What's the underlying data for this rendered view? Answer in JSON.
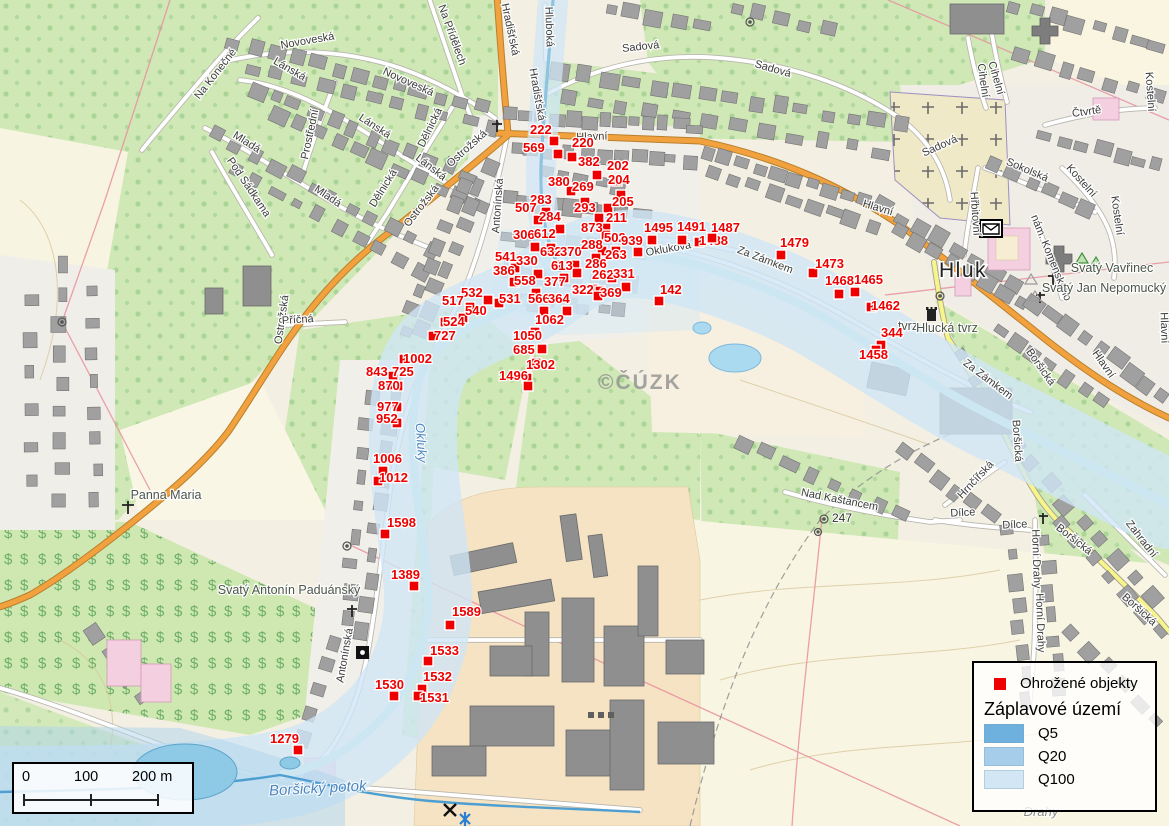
{
  "legend": {
    "objects_label": "Ohrožené objekty",
    "flood_title": "Záplavové území",
    "marker_color": "#ee0000",
    "flood_zones": [
      {
        "label": "Q5",
        "color": "#6fb1de"
      },
      {
        "label": "Q20",
        "color": "#a6cde9"
      },
      {
        "label": "Q100",
        "color": "#d2e6f4"
      }
    ]
  },
  "scalebar": {
    "labels": [
      "0",
      "100",
      "200 m"
    ]
  },
  "watermark": "©ČÚZK",
  "rivers": [
    {
      "name": "Okluky",
      "x": 417,
      "y": 443,
      "r": 86,
      "cls": "riv"
    },
    {
      "name": "Boršický potok",
      "x": 318,
      "y": 793,
      "r": -3,
      "cls": "rivbig"
    }
  ],
  "poi_labels": [
    {
      "t": "Hluk",
      "x": 963,
      "y": 277,
      "cls": "town"
    },
    {
      "t": "Svatý Vavřinec",
      "x": 1112,
      "y": 272,
      "cls": "poi"
    },
    {
      "t": "Svatý Jan Nepomucký",
      "x": 1104,
      "y": 292,
      "cls": "poi"
    },
    {
      "t": "tvrz",
      "x": 908,
      "y": 330,
      "cls": "poi"
    },
    {
      "t": "Hlucká tvrz",
      "x": 947,
      "y": 332,
      "cls": "poi"
    },
    {
      "t": "Panna Maria",
      "x": 166,
      "y": 499,
      "cls": "poi"
    },
    {
      "t": "Svatý Antonín Paduánský",
      "x": 289,
      "y": 594,
      "cls": "poi"
    },
    {
      "t": "247",
      "x": 842,
      "y": 522,
      "cls": "elev"
    },
    {
      "t": "Drahy",
      "x": 1041,
      "y": 816,
      "cls": "locality"
    }
  ],
  "street_labels": [
    {
      "t": "Hlavní",
      "x": 592,
      "y": 140,
      "r": -2
    },
    {
      "t": "Hlavní",
      "x": 877,
      "y": 211,
      "r": 17
    },
    {
      "t": "Hlavní",
      "x": 1101,
      "y": 366,
      "r": 55
    },
    {
      "t": "Hlavní",
      "x": 1161,
      "y": 328,
      "r": 88
    },
    {
      "t": "Hradišťská",
      "x": 507,
      "y": 30,
      "r": 78
    },
    {
      "t": "Hradišťská",
      "x": 534,
      "y": 95,
      "r": 80
    },
    {
      "t": "Hluboká",
      "x": 546,
      "y": 27,
      "r": 88
    },
    {
      "t": "Sadová",
      "x": 641,
      "y": 50,
      "r": -6
    },
    {
      "t": "Sadová",
      "x": 772,
      "y": 72,
      "r": 16
    },
    {
      "t": "Sadová",
      "x": 941,
      "y": 149,
      "r": -24
    },
    {
      "t": "Novoveská",
      "x": 308,
      "y": 44,
      "r": -10
    },
    {
      "t": "Novoveská",
      "x": 407,
      "y": 85,
      "r": 24
    },
    {
      "t": "Lánská",
      "x": 288,
      "y": 72,
      "r": 30
    },
    {
      "t": "Lánská",
      "x": 373,
      "y": 129,
      "r": 33
    },
    {
      "t": "Lánská",
      "x": 429,
      "y": 170,
      "r": 38
    },
    {
      "t": "Na Konečné",
      "x": 218,
      "y": 76,
      "r": -52
    },
    {
      "t": "Na Přídělech",
      "x": 449,
      "y": 36,
      "r": 70
    },
    {
      "t": "Prostřední",
      "x": 313,
      "y": 135,
      "r": -78
    },
    {
      "t": "Mladá",
      "x": 245,
      "y": 145,
      "r": 32
    },
    {
      "t": "Mladá",
      "x": 326,
      "y": 199,
      "r": 34
    },
    {
      "t": "Dělnická",
      "x": 433,
      "y": 129,
      "r": -64
    },
    {
      "t": "Dělnická",
      "x": 386,
      "y": 190,
      "r": -58
    },
    {
      "t": "Pod Sádkama",
      "x": 246,
      "y": 189,
      "r": 56
    },
    {
      "t": "Ostrožská",
      "x": 469,
      "y": 151,
      "r": -42
    },
    {
      "t": "Ostrožská",
      "x": 424,
      "y": 208,
      "r": -52
    },
    {
      "t": "Ostrožská",
      "x": 285,
      "y": 320,
      "r": -82
    },
    {
      "t": "Antonínská",
      "x": 501,
      "y": 206,
      "r": -86
    },
    {
      "t": "Antonínská",
      "x": 348,
      "y": 656,
      "r": -80
    },
    {
      "t": "Příčná",
      "x": 298,
      "y": 323,
      "r": -4
    },
    {
      "t": "Okluková",
      "x": 669,
      "y": 252,
      "r": -10
    },
    {
      "t": "Za Zámkem",
      "x": 764,
      "y": 263,
      "r": 21
    },
    {
      "t": "Za Zámkem",
      "x": 986,
      "y": 382,
      "r": 37
    },
    {
      "t": "Sokolská",
      "x": 1026,
      "y": 173,
      "r": 23
    },
    {
      "t": "Kostelní",
      "x": 1079,
      "y": 183,
      "r": 48
    },
    {
      "t": "Kostelní",
      "x": 1114,
      "y": 216,
      "r": 82
    },
    {
      "t": "Kostelní",
      "x": 1147,
      "y": 92,
      "r": 86
    },
    {
      "t": "Čtvrtě",
      "x": 1087,
      "y": 115,
      "r": -8
    },
    {
      "t": "Cihelní",
      "x": 980,
      "y": 81,
      "r": 82
    },
    {
      "t": "Cihelní",
      "x": 993,
      "y": 79,
      "r": 74
    },
    {
      "t": "Hřbitovní",
      "x": 972,
      "y": 214,
      "r": 86
    },
    {
      "t": "nám. Komenského",
      "x": 1048,
      "y": 259,
      "r": 68
    },
    {
      "t": "Nad Kaštancem",
      "x": 839,
      "y": 503,
      "r": 11
    },
    {
      "t": "Hrnčířská",
      "x": 978,
      "y": 482,
      "r": -47
    },
    {
      "t": "Dílce",
      "x": 963,
      "y": 516,
      "r": -3
    },
    {
      "t": "Dílce",
      "x": 1015,
      "y": 528,
      "r": -3
    },
    {
      "t": "Horní Drahy",
      "x": 1033,
      "y": 559,
      "r": 88
    },
    {
      "t": "Horní Drahy",
      "x": 1037,
      "y": 623,
      "r": 88
    },
    {
      "t": "Boršická",
      "x": 1038,
      "y": 369,
      "r": 55
    },
    {
      "t": "Boršická",
      "x": 1014,
      "y": 441,
      "r": 86
    },
    {
      "t": "Boršická",
      "x": 1072,
      "y": 542,
      "r": 38
    },
    {
      "t": "Boršická",
      "x": 1137,
      "y": 612,
      "r": 42
    },
    {
      "t": "Zahradní",
      "x": 1139,
      "y": 541,
      "r": 52
    }
  ],
  "markers": [
    {
      "n": "222",
      "mx": 549,
      "my": 136,
      "lx": 530,
      "ly": 134
    },
    {
      "n": "569",
      "mx": 553,
      "my": 149,
      "lx": 523,
      "ly": 152
    },
    {
      "n": "220",
      "mx": 567,
      "my": 152,
      "lx": 572,
      "ly": 147
    },
    {
      "n": "382",
      "mx": 592,
      "my": 170,
      "lx": 578,
      "ly": 166
    },
    {
      "n": "202",
      "mx": 612,
      "my": 176,
      "lx": 607,
      "ly": 170
    },
    {
      "n": "204",
      "mx": 616,
      "my": 190,
      "lx": 608,
      "ly": 184
    },
    {
      "n": "380",
      "mx": 566,
      "my": 186,
      "lx": 548,
      "ly": 186
    },
    {
      "n": "269",
      "mx": 580,
      "my": 197,
      "lx": 572,
      "ly": 191
    },
    {
      "n": "283",
      "mx": 541,
      "my": 207,
      "lx": 530,
      "ly": 204
    },
    {
      "n": "205",
      "mx": 603,
      "my": 203,
      "lx": 612,
      "ly": 206
    },
    {
      "n": "507",
      "mx": 533,
      "my": 215,
      "lx": 515,
      "ly": 212
    },
    {
      "n": "284",
      "mx": 555,
      "my": 224,
      "lx": 539,
      "ly": 221
    },
    {
      "n": "293",
      "mx": 594,
      "my": 213,
      "lx": 574,
      "ly": 212
    },
    {
      "n": "211",
      "mx": 601,
      "my": 223,
      "lx": 606,
      "ly": 222
    },
    {
      "n": "873",
      "mx": 601,
      "my": 230,
      "lx": 581,
      "ly": 232
    },
    {
      "n": "306",
      "mx": 530,
      "my": 242,
      "lx": 513,
      "ly": 239
    },
    {
      "n": "612",
      "mx": 546,
      "my": 243,
      "lx": 534,
      "ly": 238
    },
    {
      "n": "502",
      "mx": 597,
      "my": 246,
      "lx": 604,
      "ly": 242
    },
    {
      "n": "939",
      "mx": 633,
      "my": 247,
      "lx": 621,
      "ly": 245
    },
    {
      "n": "1495",
      "mx": 647,
      "my": 235,
      "lx": 644,
      "ly": 232
    },
    {
      "n": "1491",
      "mx": 677,
      "my": 235,
      "lx": 677,
      "ly": 231
    },
    {
      "n": "1488",
      "mx": 694,
      "my": 237,
      "lx": 699,
      "ly": 245
    },
    {
      "n": "1487",
      "mx": 707,
      "my": 233,
      "lx": 711,
      "ly": 232
    },
    {
      "n": "541",
      "mx": 510,
      "my": 263,
      "lx": 495,
      "ly": 261
    },
    {
      "n": "330",
      "mx": 533,
      "my": 269,
      "lx": 516,
      "ly": 265
    },
    {
      "n": "632",
      "mx": 552,
      "my": 260,
      "lx": 540,
      "ly": 256
    },
    {
      "n": "370",
      "mx": 570,
      "my": 260,
      "lx": 560,
      "ly": 256
    },
    {
      "n": "288",
      "mx": 591,
      "my": 253,
      "lx": 581,
      "ly": 249
    },
    {
      "n": "263",
      "mx": 611,
      "my": 246,
      "lx": 605,
      "ly": 259
    },
    {
      "n": "386",
      "mx": 509,
      "my": 277,
      "lx": 493,
      "ly": 275
    },
    {
      "n": "613",
      "mx": 572,
      "my": 268,
      "lx": 551,
      "ly": 270
    },
    {
      "n": "286",
      "mx": 607,
      "my": 273,
      "lx": 585,
      "ly": 268
    },
    {
      "n": "558",
      "mx": 531,
      "my": 288,
      "lx": 514,
      "ly": 285
    },
    {
      "n": "377",
      "mx": 559,
      "my": 273,
      "lx": 544,
      "ly": 286
    },
    {
      "n": "262",
      "mx": 588,
      "my": 284,
      "lx": 592,
      "ly": 279
    },
    {
      "n": "331",
      "mx": 621,
      "my": 282,
      "lx": 613,
      "ly": 278
    },
    {
      "n": "531",
      "mx": 494,
      "my": 298,
      "lx": 499,
      "ly": 303
    },
    {
      "n": "322",
      "mx": 595,
      "my": 286,
      "lx": 572,
      "ly": 294
    },
    {
      "n": "369",
      "mx": 593,
      "my": 291,
      "lx": 600,
      "ly": 297
    },
    {
      "n": "566",
      "mx": 539,
      "my": 306,
      "lx": 528,
      "ly": 303
    },
    {
      "n": "364",
      "mx": 562,
      "my": 306,
      "lx": 548,
      "ly": 303
    },
    {
      "n": "532",
      "mx": 483,
      "my": 295,
      "lx": 461,
      "ly": 297
    },
    {
      "n": "517",
      "mx": 465,
      "my": 302,
      "lx": 442,
      "ly": 305
    },
    {
      "n": "540",
      "mx": 458,
      "my": 313,
      "lx": 465,
      "ly": 315
    },
    {
      "n": "524",
      "mx": 440,
      "my": 317,
      "lx": 443,
      "ly": 326
    },
    {
      "n": "727",
      "mx": 428,
      "my": 331,
      "lx": 434,
      "ly": 340
    },
    {
      "n": "1002",
      "mx": 399,
      "my": 354,
      "lx": 403,
      "ly": 363
    },
    {
      "n": "843",
      "mx": 388,
      "my": 371,
      "lx": 366,
      "ly": 376
    },
    {
      "n": "725",
      "mx": 386,
      "my": 380,
      "lx": 392,
      "ly": 376
    },
    {
      "n": "870",
      "mx": 393,
      "my": 381,
      "lx": 378,
      "ly": 390
    },
    {
      "n": "977",
      "mx": 392,
      "my": 402,
      "lx": 377,
      "ly": 411
    },
    {
      "n": "952",
      "mx": 392,
      "my": 418,
      "lx": 376,
      "ly": 423
    },
    {
      "n": "1062",
      "mx": 530,
      "my": 327,
      "lx": 535,
      "ly": 324
    },
    {
      "n": "1050",
      "mx": 537,
      "my": 344,
      "lx": 513,
      "ly": 340
    },
    {
      "n": "685",
      "mx": 531,
      "my": 358,
      "lx": 513,
      "ly": 354
    },
    {
      "n": "1302",
      "mx": 522,
      "my": 373,
      "lx": 526,
      "ly": 369
    },
    {
      "n": "1496",
      "mx": 523,
      "my": 381,
      "lx": 499,
      "ly": 380
    },
    {
      "n": "142",
      "mx": 654,
      "my": 296,
      "lx": 660,
      "ly": 294
    },
    {
      "n": "1479",
      "mx": 776,
      "my": 250,
      "lx": 780,
      "ly": 247
    },
    {
      "n": "1473",
      "mx": 808,
      "my": 268,
      "lx": 815,
      "ly": 268
    },
    {
      "n": "1468",
      "mx": 834,
      "my": 289,
      "lx": 825,
      "ly": 285
    },
    {
      "n": "1465",
      "mx": 850,
      "my": 287,
      "lx": 854,
      "ly": 284
    },
    {
      "n": "1462",
      "mx": 866,
      "my": 302,
      "lx": 871,
      "ly": 310
    },
    {
      "n": "344",
      "mx": 876,
      "my": 340,
      "lx": 881,
      "ly": 337
    },
    {
      "n": "1458",
      "mx": 871,
      "my": 345,
      "lx": 859,
      "ly": 359
    },
    {
      "n": "1006",
      "mx": 378,
      "my": 466,
      "lx": 373,
      "ly": 463
    },
    {
      "n": "1012",
      "mx": 373,
      "my": 476,
      "lx": 379,
      "ly": 482
    },
    {
      "n": "1598",
      "mx": 380,
      "my": 529,
      "lx": 387,
      "ly": 527
    },
    {
      "n": "1389",
      "mx": 409,
      "my": 581,
      "lx": 391,
      "ly": 579
    },
    {
      "n": "1589",
      "mx": 445,
      "my": 620,
      "lx": 452,
      "ly": 616
    },
    {
      "n": "1533",
      "mx": 423,
      "my": 656,
      "lx": 430,
      "ly": 655
    },
    {
      "n": "1532",
      "mx": 417,
      "my": 684,
      "lx": 423,
      "ly": 681
    },
    {
      "n": "1531",
      "mx": 413,
      "my": 691,
      "lx": 420,
      "ly": 702
    },
    {
      "n": "1530",
      "mx": 389,
      "my": 691,
      "lx": 375,
      "ly": 689
    },
    {
      "n": "1279",
      "mx": 293,
      "my": 745,
      "lx": 270,
      "ly": 743
    }
  ]
}
